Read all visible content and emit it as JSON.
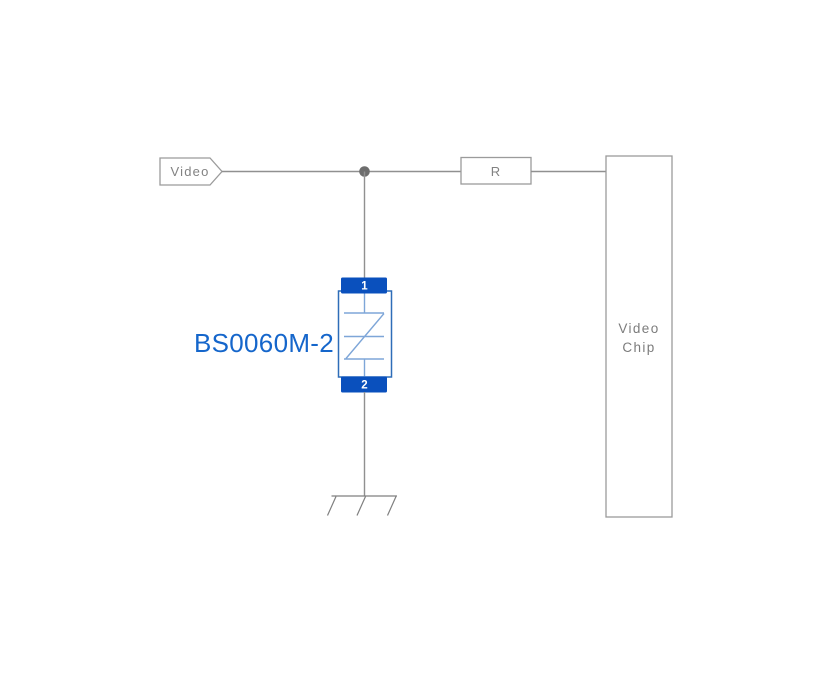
{
  "schematic": {
    "net_tag": {
      "label": "Video"
    },
    "resistor": {
      "label": "R"
    },
    "chip": {
      "label_line1": "Video",
      "label_line2": "Chip"
    },
    "protection_device": {
      "part_number": "BS0060M-2",
      "pin1_number": "1",
      "pin2_number": "2"
    },
    "colors": {
      "wire_gray": "#909090",
      "box_stroke_gray": "#9b9b9b",
      "junction_gray": "#6d6d6d",
      "pad_blue": "#0a50bd",
      "device_outline_blue": "#2e6db8",
      "device_symbol_blue": "#7ea6d8",
      "part_label_blue": "#1566cb",
      "label_gray": "#7c7c7c"
    }
  }
}
